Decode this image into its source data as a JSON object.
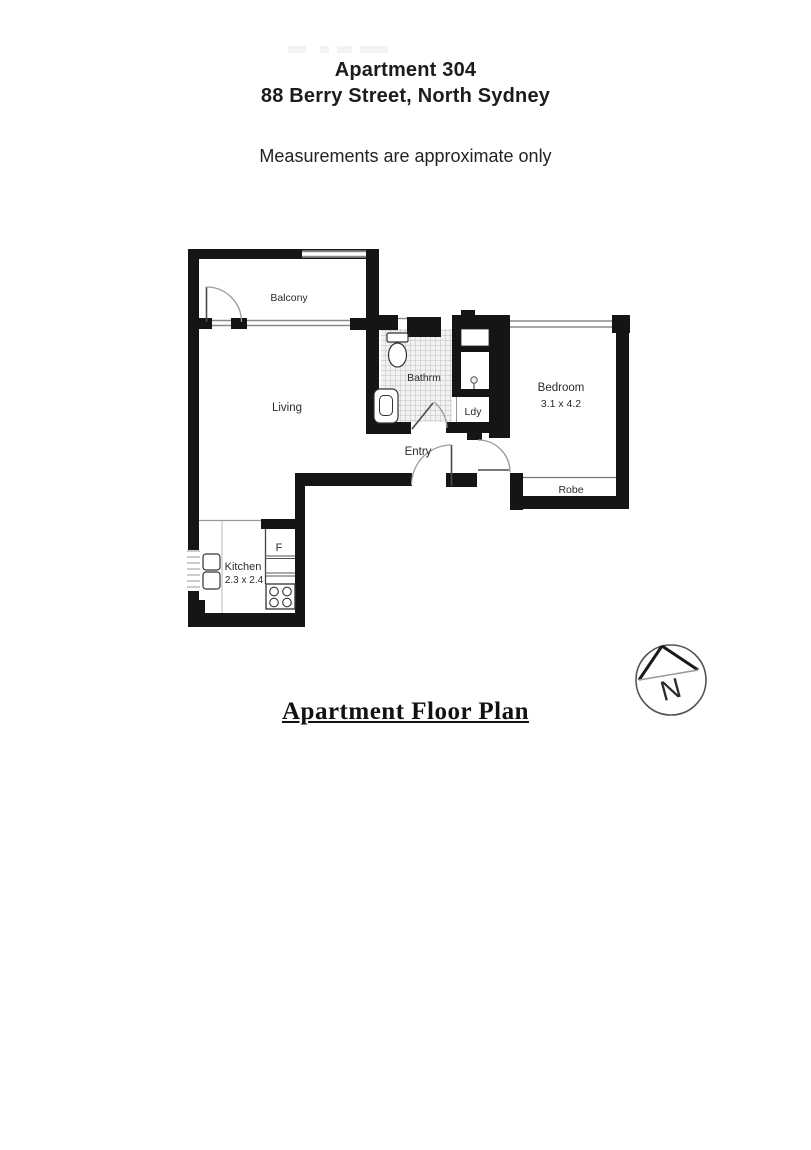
{
  "header": {
    "apartment": "Apartment 304",
    "address": "88 Berry Street, North Sydney",
    "disclaimer": "Measurements are approximate only"
  },
  "floor_plan": {
    "rooms": {
      "balcony": {
        "label": "Balcony"
      },
      "living": {
        "label": "Living"
      },
      "bathroom": {
        "label": "Bathrm"
      },
      "laundry": {
        "label": "Ldy"
      },
      "entry": {
        "label": "Entry"
      },
      "bedroom": {
        "label": "Bedroom",
        "dimensions": "3.1 x 4.2"
      },
      "robe": {
        "label": "Robe"
      },
      "kitchen": {
        "label": "Kitchen",
        "dimensions": "2.3 x 2.4"
      },
      "fridge": {
        "label": "F"
      }
    },
    "compass": {
      "north": "N"
    },
    "colors": {
      "wall": "#151515",
      "tile_line": "#c0c0c0",
      "text": "#2b2b2b"
    }
  },
  "footer": {
    "caption": "Apartment Floor Plan"
  }
}
